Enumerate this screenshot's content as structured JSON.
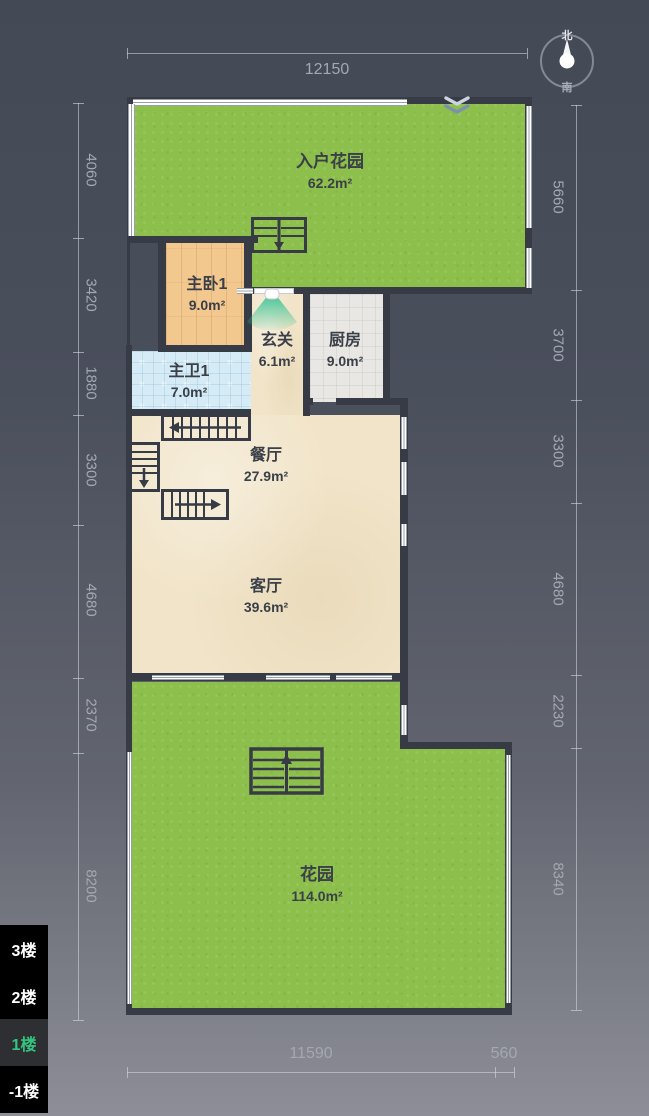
{
  "title": "户型图 1楼",
  "compass": {
    "north": "北",
    "south": "南"
  },
  "entrance": {
    "icon": "double-chevron-down"
  },
  "rooms": [
    {
      "id": "entry-garden",
      "name": "入户花园",
      "area": "62.2m²"
    },
    {
      "id": "master-bedroom",
      "name": "主卧1",
      "area": "9.0m²"
    },
    {
      "id": "hallway",
      "name": "玄关",
      "area": "6.1m²"
    },
    {
      "id": "kitchen",
      "name": "厨房",
      "area": "9.0m²"
    },
    {
      "id": "master-bath",
      "name": "主卫1",
      "area": "7.0m²"
    },
    {
      "id": "dining-room",
      "name": "餐厅",
      "area": "27.9m²"
    },
    {
      "id": "living-room",
      "name": "客厅",
      "area": "39.6m²"
    },
    {
      "id": "garden",
      "name": "花园",
      "area": "114.0m²"
    }
  ],
  "dimensions": {
    "top": [
      "12150"
    ],
    "bottom": [
      "11590",
      "560"
    ],
    "left": [
      "4060",
      "3420",
      "1880",
      "3300",
      "4680",
      "2370",
      "8200"
    ],
    "right": [
      "5660",
      "3700",
      "3300",
      "4680",
      "2230",
      "8340"
    ]
  },
  "floor_selector": {
    "items": [
      {
        "label": "3楼",
        "selected": false
      },
      {
        "label": "2楼",
        "selected": false
      },
      {
        "label": "1楼",
        "selected": true
      },
      {
        "label": "-1楼",
        "selected": false
      }
    ]
  },
  "colors": {
    "background_top": "#434955",
    "background_bottom": "#8d8e97",
    "wall": "#363b45",
    "garden_green": "#8dbf4c",
    "wood": "#f2c88f",
    "beige": "#f1e4c8",
    "kitchen_tile": "#e9e7e3",
    "bath_tile": "#d5ebf5",
    "door_swing": "#27c08f",
    "selected_floor_text": "#33c57f",
    "dimension_text": "#a4a8b2",
    "room_text": "#3a3f48"
  }
}
